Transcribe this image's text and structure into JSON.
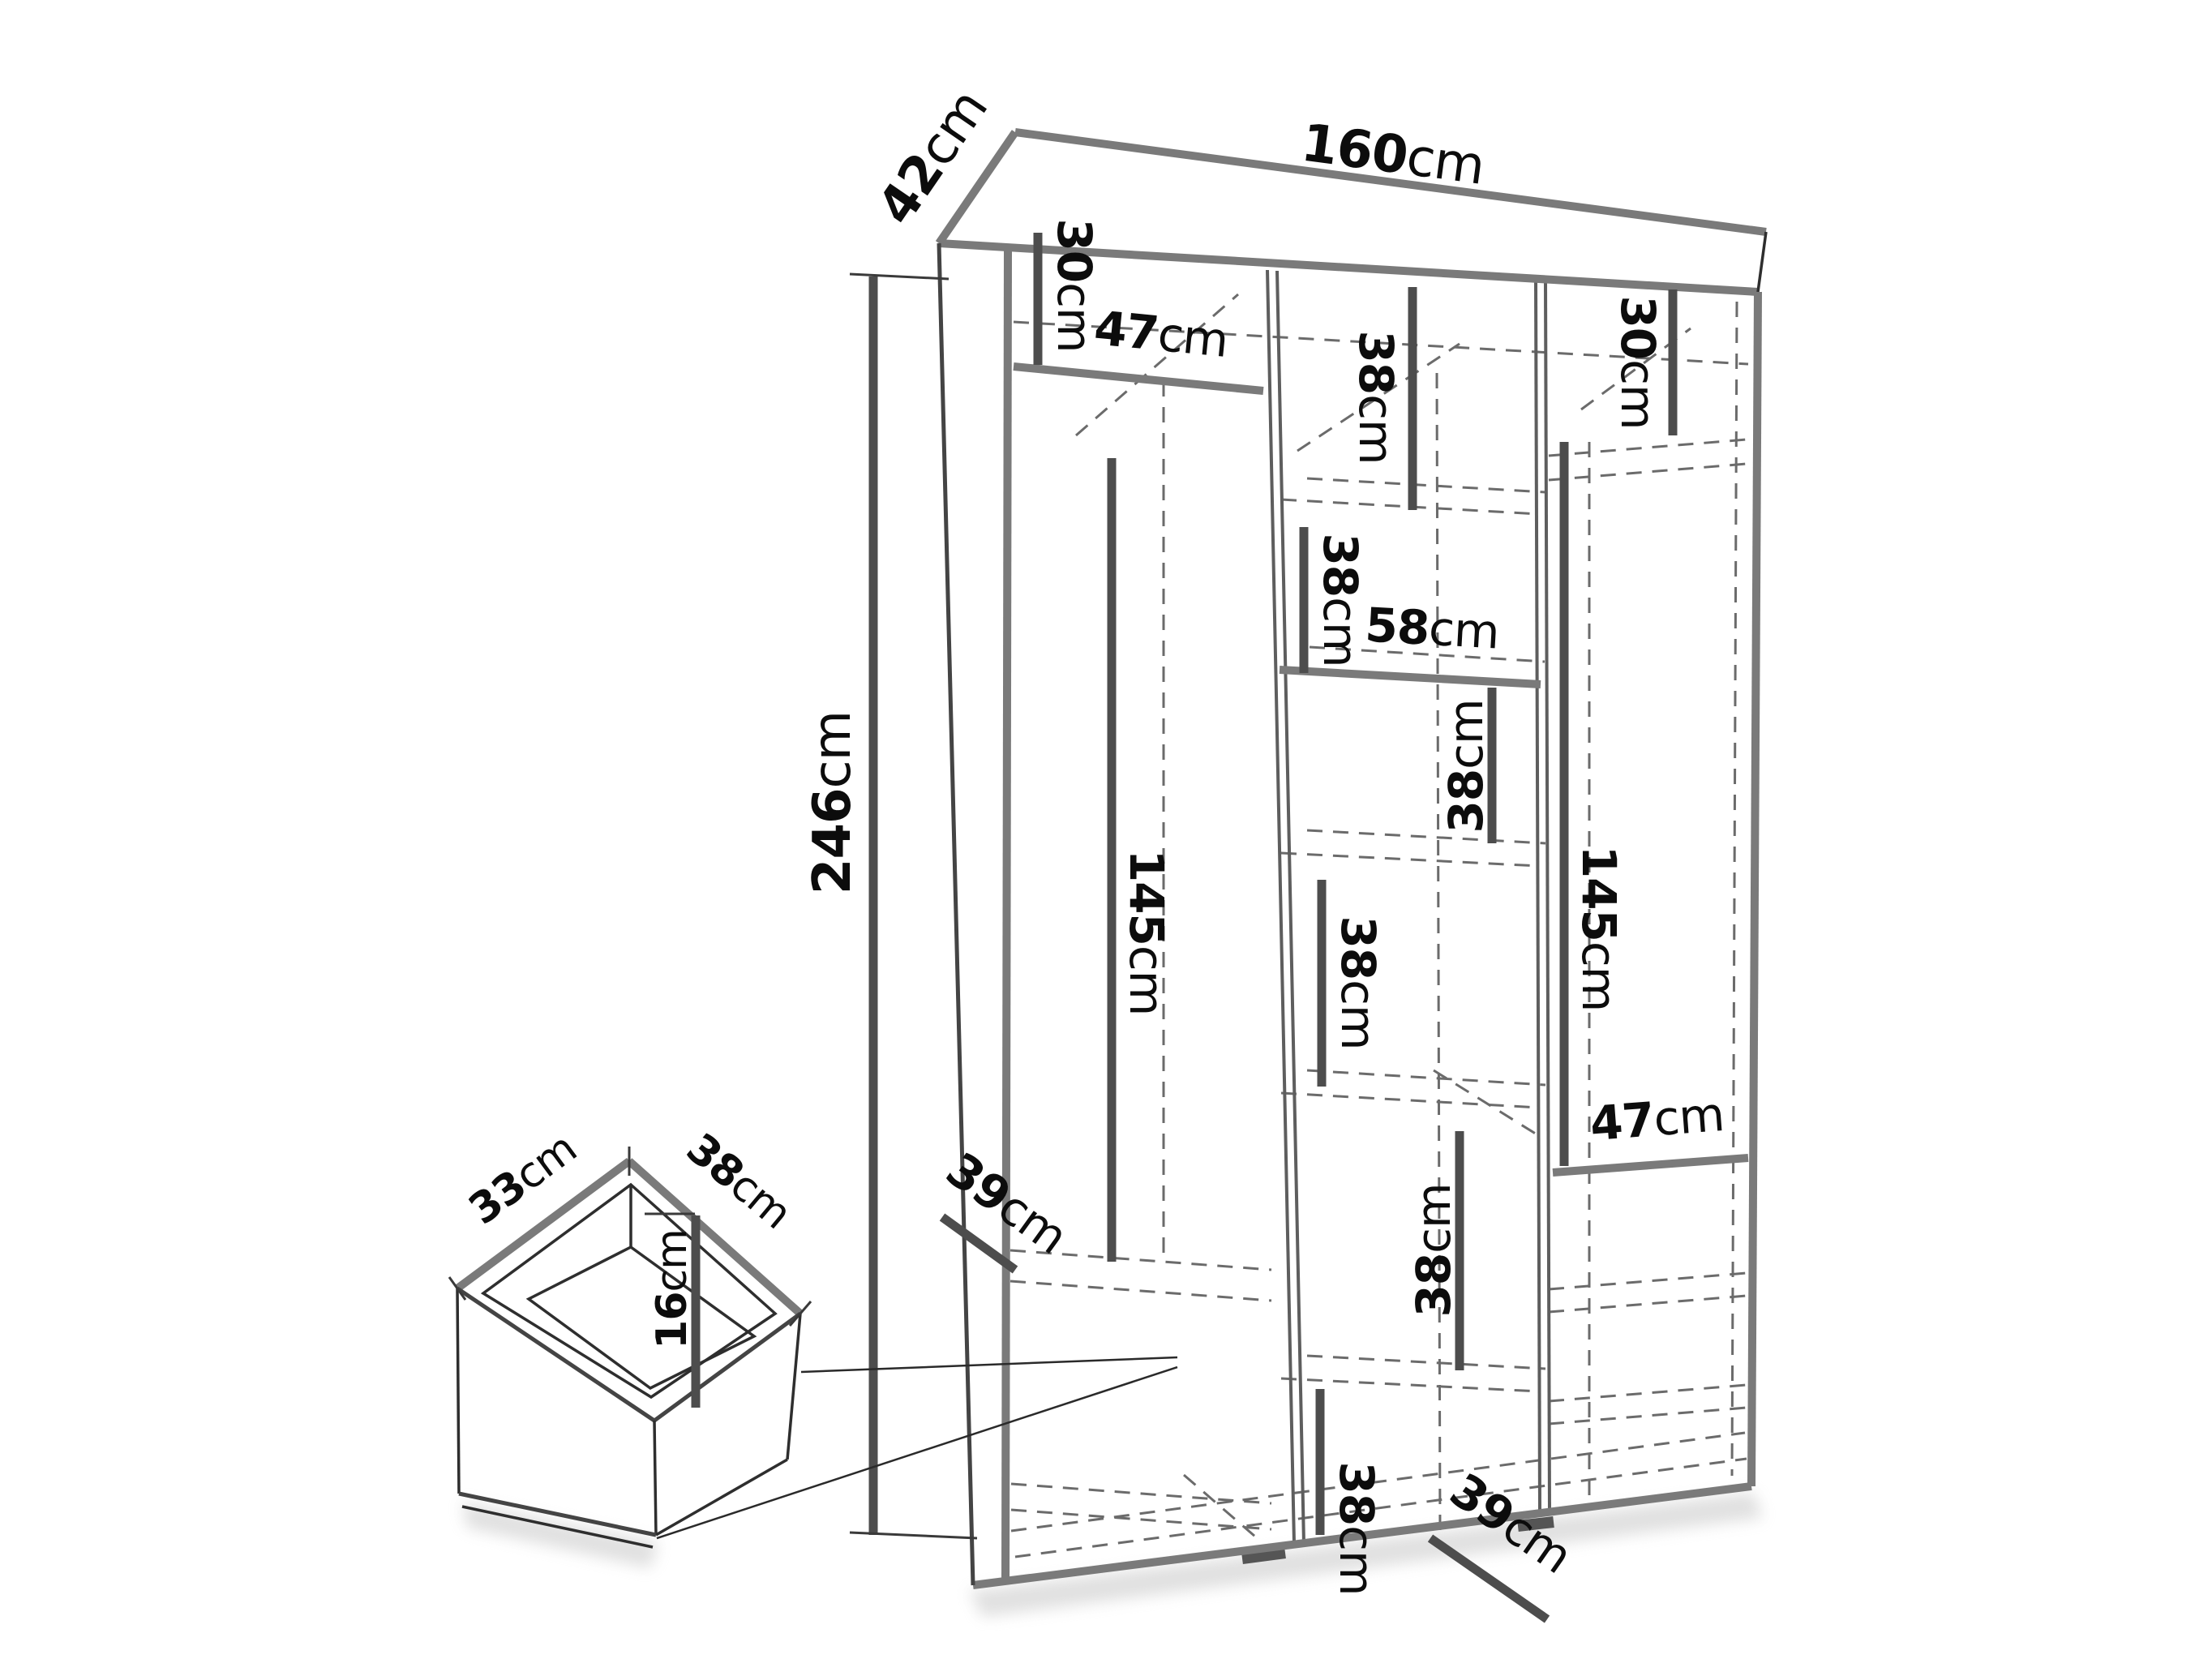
{
  "diagram": {
    "type": "furniture-dimension-drawing",
    "subject": "wardrobe with interior shelving and drawer detail",
    "background_color": "#ffffff",
    "structure_line_color": "#7a7a7a",
    "dimension_bar_color": "#4d4d4d",
    "text_color": "#0c0c0c",
    "unit": "cm"
  },
  "dims": {
    "width_160": {
      "value": "160",
      "unit": "cm"
    },
    "depth_42": {
      "value": "42",
      "unit": "cm"
    },
    "height_246": {
      "value": "246",
      "unit": "cm"
    },
    "left_top_30": {
      "value": "30",
      "unit": "cm"
    },
    "left_shelf_47": {
      "value": "47",
      "unit": "cm"
    },
    "left_hang_145": {
      "value": "145",
      "unit": "cm"
    },
    "left_depth_39": {
      "value": "39",
      "unit": "cm"
    },
    "mid_38_top": {
      "value": "38",
      "unit": "cm"
    },
    "mid_38_second": {
      "value": "38",
      "unit": "cm"
    },
    "mid_shelf_58": {
      "value": "58",
      "unit": "cm"
    },
    "mid_38_third": {
      "value": "38",
      "unit": "cm"
    },
    "mid_38_fourth": {
      "value": "38",
      "unit": "cm"
    },
    "mid_38_fifth": {
      "value": "38",
      "unit": "cm"
    },
    "mid_38_bottom": {
      "value": "38",
      "unit": "cm"
    },
    "mid_depth_39": {
      "value": "39",
      "unit": "cm"
    },
    "right_top_30": {
      "value": "30",
      "unit": "cm"
    },
    "right_hang_145": {
      "value": "145",
      "unit": "cm"
    },
    "right_shelf_47": {
      "value": "47",
      "unit": "cm"
    },
    "drawer_inner_depth_33": {
      "value": "33",
      "unit": "cm"
    },
    "drawer_inner_width_38": {
      "value": "38",
      "unit": "cm"
    },
    "drawer_inner_height_16": {
      "value": "16",
      "unit": "cm"
    }
  }
}
